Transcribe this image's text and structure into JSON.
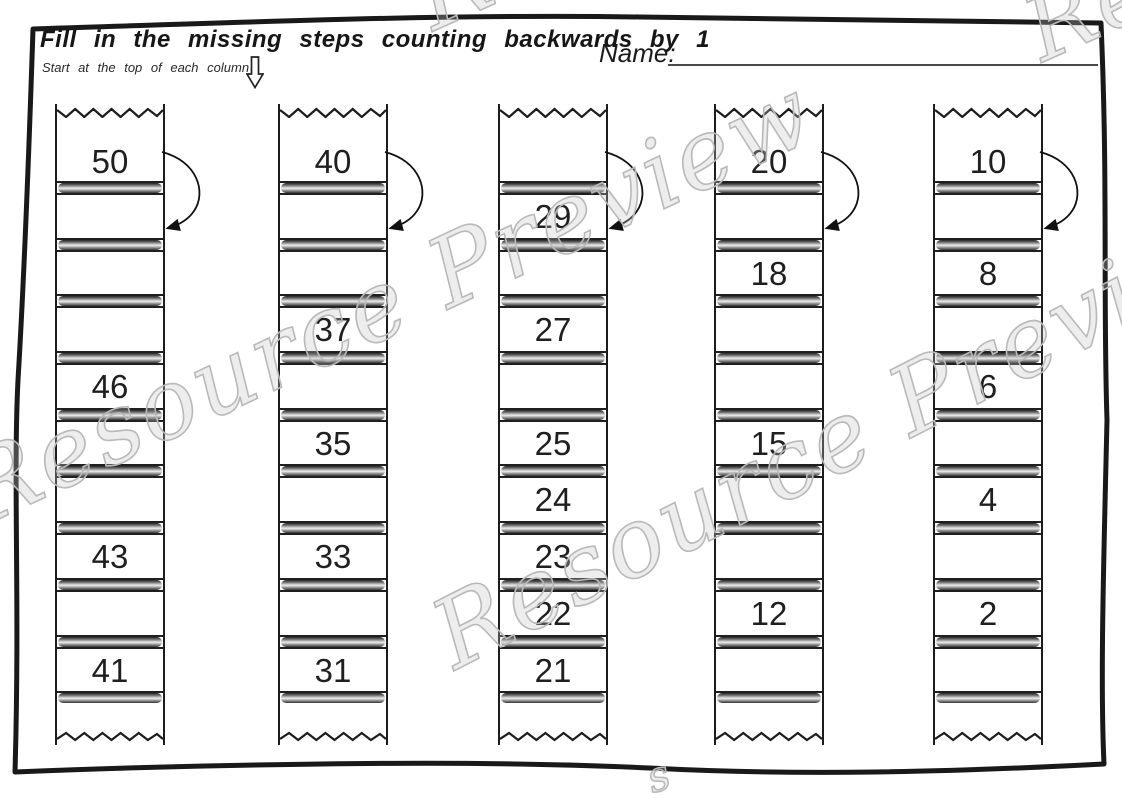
{
  "page": {
    "title": "Fill in the missing steps counting backwards by 1",
    "subtitle": "Start at the top of each column",
    "name_label": "Name:"
  },
  "watermark": {
    "text": "Resource Preview",
    "corner_fragment": "Re",
    "bottom_fragment": "s",
    "color": "#b9b9b9"
  },
  "worksheet": {
    "columns": [
      {
        "label": "column-1",
        "steps": [
          "50",
          null,
          null,
          null,
          "46",
          null,
          null,
          "43",
          null,
          "41"
        ]
      },
      {
        "label": "column-2",
        "steps": [
          "40",
          null,
          null,
          "37",
          null,
          "35",
          null,
          "33",
          null,
          "31"
        ]
      },
      {
        "label": "column-3",
        "steps": [
          null,
          "29",
          null,
          "27",
          null,
          "25",
          "24",
          "23",
          "22",
          "21"
        ]
      },
      {
        "label": "column-4",
        "steps": [
          "20",
          null,
          "18",
          null,
          null,
          "15",
          null,
          null,
          "12",
          null
        ]
      },
      {
        "label": "column-5",
        "steps": [
          "10",
          null,
          "8",
          null,
          "6",
          null,
          "4",
          null,
          "2",
          null
        ]
      }
    ]
  }
}
